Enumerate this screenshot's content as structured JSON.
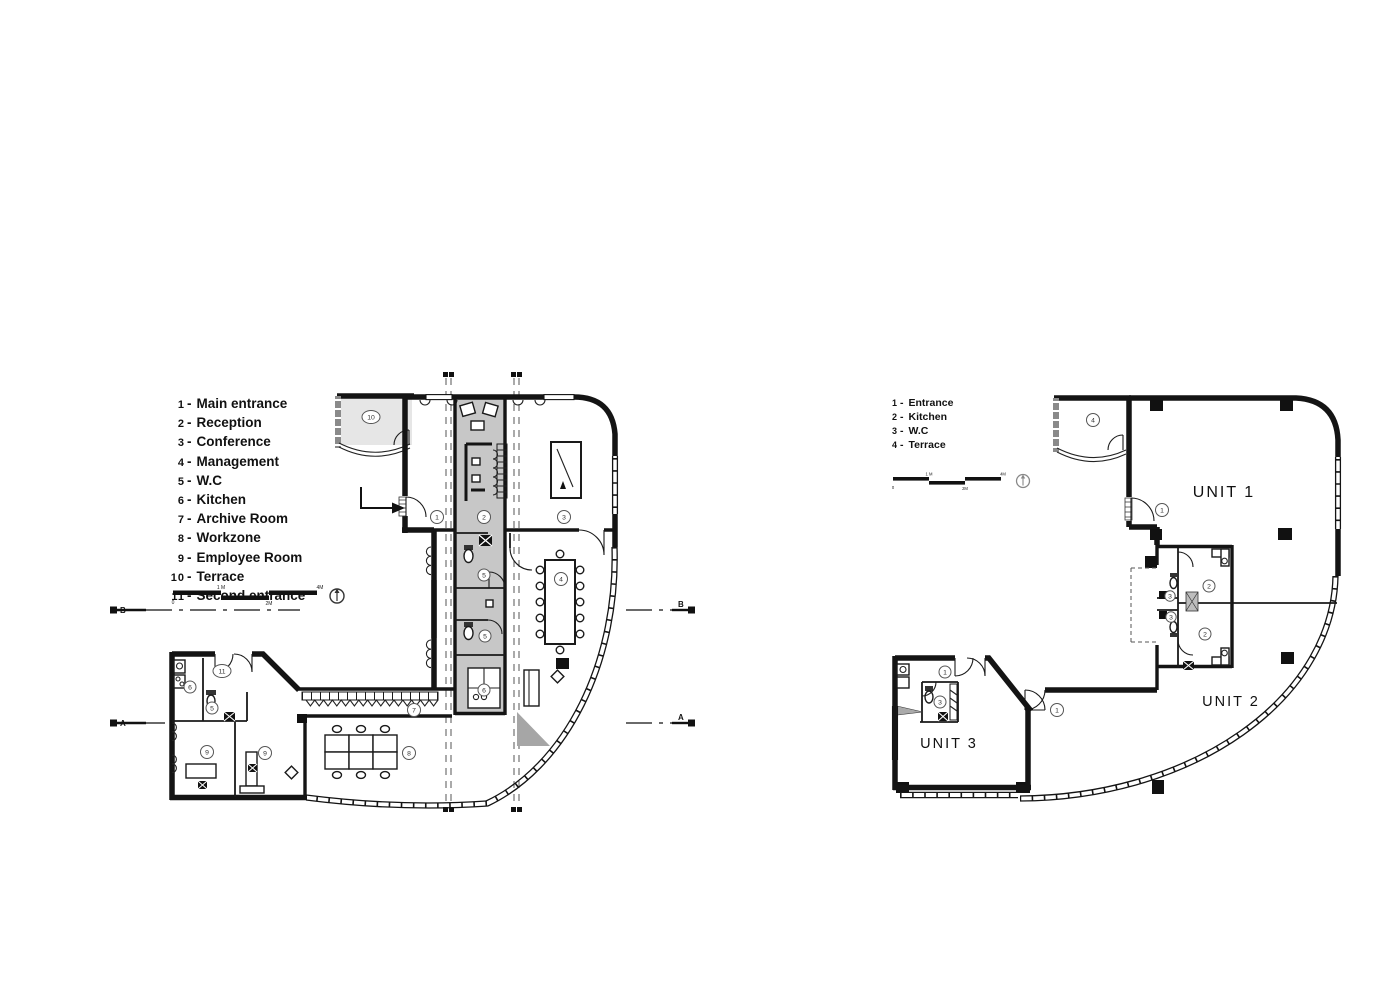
{
  "left_plan": {
    "legend": [
      {
        "num": "1",
        "label": "Main entrance"
      },
      {
        "num": "2",
        "label": "Reception"
      },
      {
        "num": "3",
        "label": "Conference"
      },
      {
        "num": "4",
        "label": "Management"
      },
      {
        "num": "5",
        "label": "W.C"
      },
      {
        "num": "6",
        "label": "Kitchen"
      },
      {
        "num": "7",
        "label": "Archive Room"
      },
      {
        "num": "8",
        "label": "Workzone"
      },
      {
        "num": "9",
        "label": "Employee Room"
      },
      {
        "num": "10",
        "label": "Terrace"
      },
      {
        "num": "11",
        "label": "Second entrance"
      }
    ],
    "scale": {
      "m0": "0",
      "m1": "1 M",
      "m2": "2M",
      "m4": "4M"
    },
    "sections": {
      "top": "B",
      "bottom": "A"
    },
    "markers": {
      "terrace": "10",
      "main_entrance": "1",
      "reception": "2",
      "conference": "3",
      "management": "4",
      "wc_top": "5",
      "wc_mid": "5",
      "kitchen_core": "6",
      "second_entrance": "11",
      "kitchen_west": "6",
      "wc_west": "5",
      "employee_a": "9",
      "employee_b": "9",
      "archive": "7",
      "workzone": "8"
    }
  },
  "right_plan": {
    "legend": [
      {
        "num": "1",
        "label": "Entrance"
      },
      {
        "num": "2",
        "label": "Kitchen"
      },
      {
        "num": "3",
        "label": "W.C"
      },
      {
        "num": "4",
        "label": "Terrace"
      }
    ],
    "scale": {
      "m0": "0",
      "m1": "1 M",
      "m2": "2M",
      "m4": "4M"
    },
    "units": {
      "u1": "UNIT 1",
      "u2": "UNIT 2",
      "u3": "UNIT 3"
    },
    "markers": {
      "terrace": "4",
      "unit1_entrance": "1",
      "unit1_kitchen": "2",
      "unit1_wc": "3",
      "unit2_wc": "3",
      "unit2_kitchen": "2",
      "unit2_entrance": "1",
      "unit3_entrance": "1",
      "unit3_wc": "3"
    }
  }
}
